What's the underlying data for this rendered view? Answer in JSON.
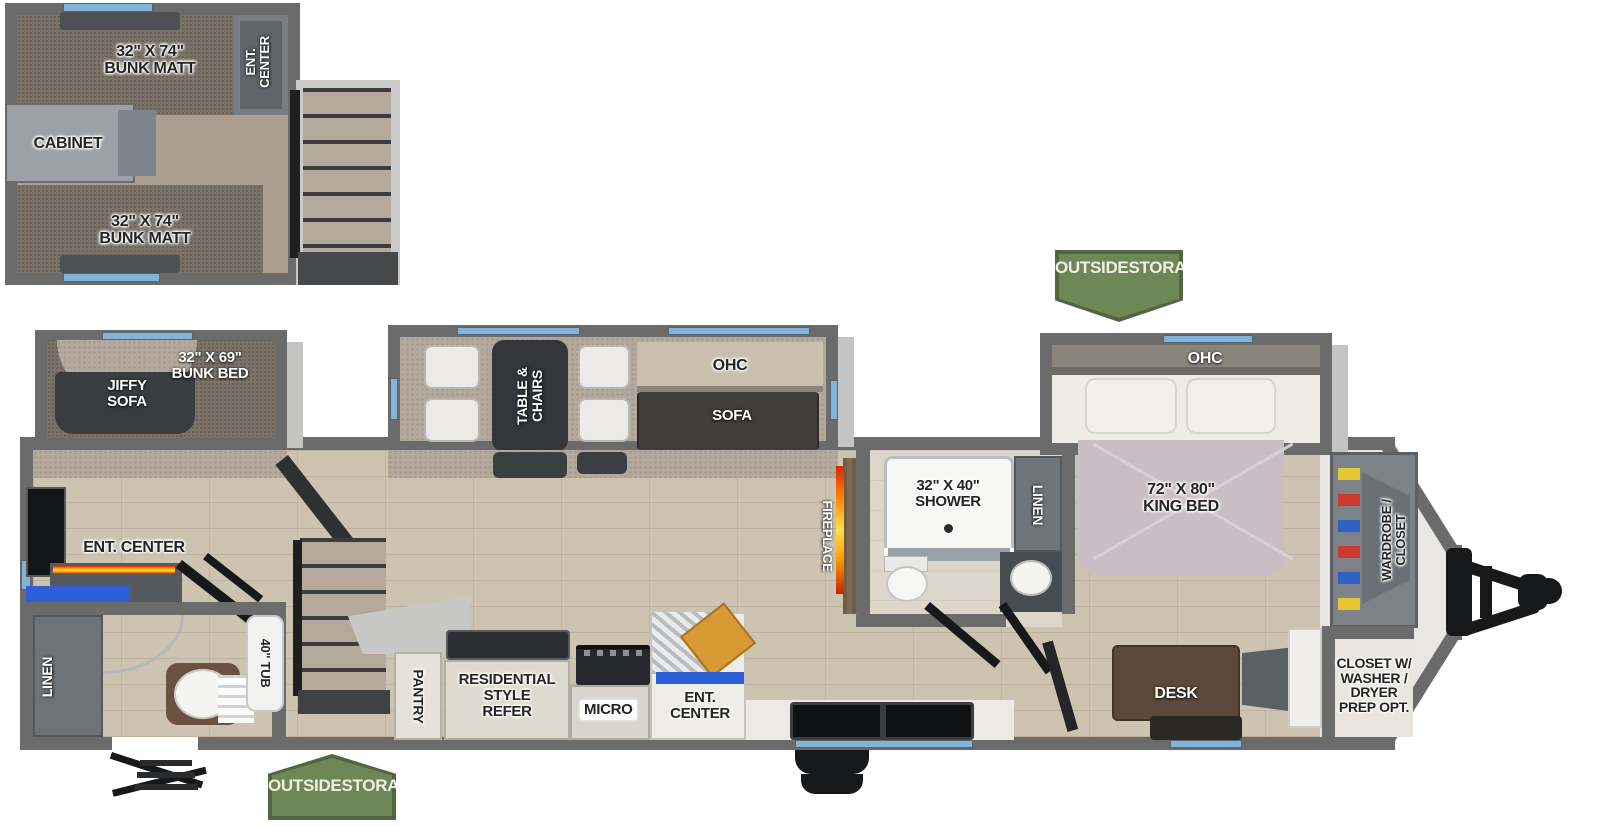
{
  "labels": {
    "bunk_matt_1": "32\" X 74\"",
    "bunk_matt_2": "BUNK MATT",
    "ent_1": "ENT.",
    "ent_2": "CENTER",
    "ent_full": "ENT. CENTER",
    "cabinet": "CABINET",
    "jiffy_1": "JIFFY",
    "jiffy_2": "SOFA",
    "bunkbed_1": "32\" X 69\"",
    "bunkbed_2": "BUNK BED",
    "linen": "LINEN",
    "tub": "40\" TUB",
    "table_1": "TABLE &",
    "table_2": "CHAIRS",
    "ohc": "OHC",
    "sofa": "SOFA",
    "pantry": "PANTRY",
    "refer_1": "RESIDENTIAL",
    "refer_2": "STYLE",
    "refer_3": "REFER",
    "micro": "MICRO",
    "fireplace": "FIREPLACE",
    "shower_1": "32\" X 40\"",
    "shower_2": "SHOWER",
    "kingbed_1": "72\" X 80\"",
    "kingbed_2": "KING BED",
    "desk": "DESK",
    "wardrobe_1": "WARDROBE /",
    "wardrobe_2": "CLOSET",
    "closetw_1": "CLOSET W/",
    "closetw_2": "WASHER /",
    "closetw_3": "DRYER",
    "closetw_4": "PREP OPT.",
    "outside_1": "OUTSIDE",
    "outside_2": "STORAGE"
  },
  "colors": {
    "wall": "#6b6b6b",
    "window": "#82b4da",
    "badge_green": "#6d8757",
    "fireplace_orange": "#ff7a00",
    "accent_blue": "#2e5fd7"
  }
}
